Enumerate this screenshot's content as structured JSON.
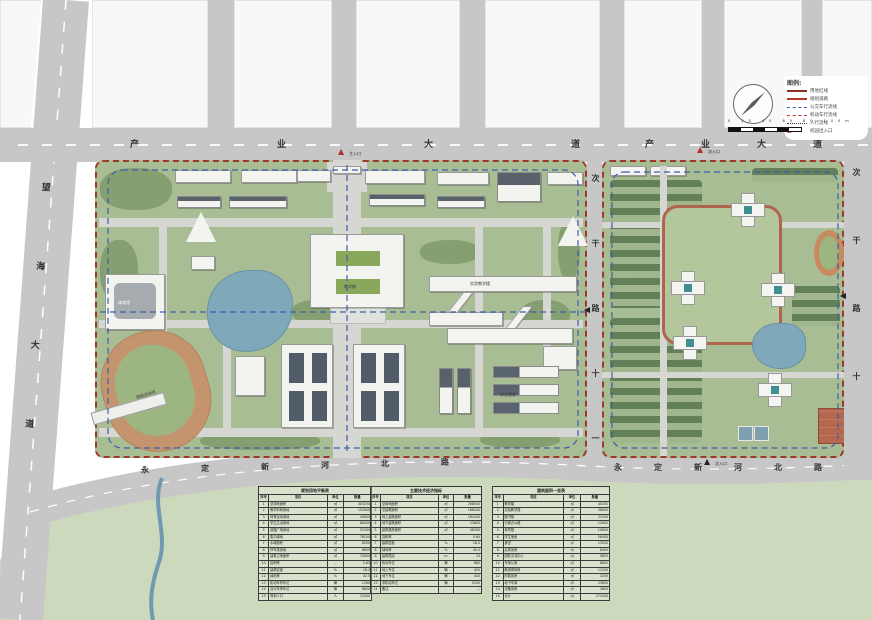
{
  "roads": {
    "industry_avenue_left": "产业大道",
    "industry_avenue_right": "产业大道",
    "wanghai_avenue": "望海大道",
    "yongding_north_left": "永定新河北路",
    "yongding_north_right": "永定新河北路",
    "secondary_road_mid": "次干路十一",
    "secondary_road_east": "次干路十"
  },
  "entrances": {
    "main": "主入口",
    "secondary_top": "次入口",
    "secondary_bottom": "次入口"
  },
  "buildings": {
    "stadium": "田径运动场",
    "gym": "体育馆",
    "main_teaching": "教学楼",
    "lab": "实验教学楼",
    "dorm": "学生宿舍"
  },
  "legend": {
    "title": "图例:",
    "items": [
      {
        "label": "用地红线"
      },
      {
        "label": "规划道路"
      },
      {
        "label": "公交车行流线"
      },
      {
        "label": "机动车行流线"
      },
      {
        "label": "人行流线"
      },
      {
        "label": "校园出入口"
      }
    ],
    "scale_ticks": "0 20 40 60 80 100m"
  },
  "tables": [
    {
      "title": "规划用地平衡表",
      "columns": [
        "序号",
        "项目",
        "单位",
        "数量"
      ],
      "rows": [
        [
          "1",
          "总用地面积",
          "㎡",
          "403200"
        ],
        [
          "2",
          "教学科研用地",
          "㎡",
          "152600"
        ],
        [
          "3",
          "体育运动用地",
          "㎡",
          "45800"
        ],
        [
          "4",
          "学生生活用地",
          "㎡",
          "68400"
        ],
        [
          "5",
          "道路广场用地",
          "㎡",
          "52300"
        ],
        [
          "6",
          "集中绿地",
          "㎡",
          "76100"
        ],
        [
          "7",
          "水域面积",
          "㎡",
          "8000"
        ],
        [
          "8",
          "停车场用地",
          "㎡",
          "6800"
        ],
        [
          "9",
          "建筑占地面积",
          "㎡",
          "72600"
        ],
        [
          "10",
          "容积率",
          "-",
          "0.82"
        ],
        [
          "11",
          "建筑密度",
          "%",
          "18.0"
        ],
        [
          "12",
          "绿地率",
          "%",
          "42.5"
        ],
        [
          "13",
          "机动车停车位",
          "辆",
          "1260"
        ],
        [
          "14",
          "自行车停车位",
          "辆",
          "8600"
        ],
        [
          "15",
          "规划人口",
          "人",
          "12000"
        ]
      ]
    },
    {
      "title": "主要技术经济指标",
      "columns": [
        "序号",
        "项目",
        "单位",
        "数量"
      ],
      "rows": [
        [
          "1",
          "总用地面积",
          "㎡",
          "268500"
        ],
        [
          "2",
          "总建筑面积",
          "㎡",
          "186200"
        ],
        [
          "3",
          "地上建筑面积",
          "㎡",
          "162400"
        ],
        [
          "4",
          "地下建筑面积",
          "㎡",
          "23800"
        ],
        [
          "5",
          "建筑基底面积",
          "㎡",
          "48300"
        ],
        [
          "6",
          "容积率",
          "-",
          "0.60"
        ],
        [
          "7",
          "建筑密度",
          "%",
          "18.0"
        ],
        [
          "8",
          "绿地率",
          "%",
          "40.0"
        ],
        [
          "9",
          "建筑限高",
          "m",
          "24"
        ],
        [
          "10",
          "机动车位",
          "辆",
          "860"
        ],
        [
          "11",
          "地上车位",
          "辆",
          "420"
        ],
        [
          "12",
          "地下车位",
          "辆",
          "440"
        ],
        [
          "13",
          "非机动车位",
          "辆",
          "5200"
        ],
        [
          "14",
          "备注",
          "-",
          "—"
        ]
      ]
    },
    {
      "title": "建筑面积一览表",
      "columns": [
        "序号",
        "项目",
        "单位",
        "数量"
      ],
      "rows": [
        [
          "1",
          "教学楼",
          "㎡",
          "45200"
        ],
        [
          "2",
          "实验教学楼",
          "㎡",
          "38600"
        ],
        [
          "3",
          "图书馆",
          "㎡",
          "21500"
        ],
        [
          "4",
          "行政办公楼",
          "㎡",
          "12600"
        ],
        [
          "5",
          "体育馆",
          "㎡",
          "15800"
        ],
        [
          "6",
          "学生宿舍",
          "㎡",
          "56400"
        ],
        [
          "7",
          "食堂",
          "㎡",
          "13200"
        ],
        [
          "8",
          "后勤用房",
          "㎡",
          "6400"
        ],
        [
          "9",
          "国际交流中心",
          "㎡",
          "9800"
        ],
        [
          "10",
          "专家公寓",
          "㎡",
          "8600"
        ],
        [
          "11",
          "教师周转房",
          "㎡",
          "11200"
        ],
        [
          "12",
          "附属用房",
          "㎡",
          "4200"
        ],
        [
          "13",
          "地下车库",
          "㎡",
          "23800"
        ],
        [
          "14",
          "设备用房",
          "㎡",
          "3600"
        ],
        [
          "15",
          "合计",
          "㎡",
          "271000"
        ]
      ]
    }
  ]
}
